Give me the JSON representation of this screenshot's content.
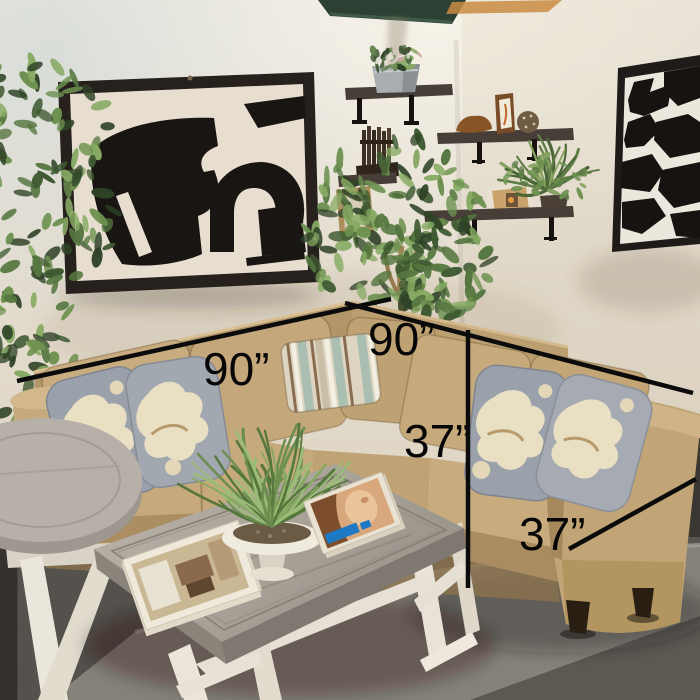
{
  "annotations": {
    "width_left": "90”",
    "width_right": "90”",
    "height": "37”",
    "depth": "37”"
  },
  "colors": {
    "dimension_line": "#0b0b0b",
    "label_text": "#060606",
    "sofa_tan": "#c3a678",
    "pillow_gray": "#9aa1ab",
    "pillow_cream": "#e9dfc2",
    "lumbar_sage": "#aabfb2",
    "lumbar_brown": "#8a6d50",
    "wall": "#e7e1d6",
    "rug": "#98928a",
    "floor_dark": "#34312e",
    "art_frame": "#26211d",
    "art_black": "#181512",
    "coffee_table_top": "#aba49b",
    "table_base_white": "#ece6da",
    "shelf_wood": "#463e37",
    "foliage_green": "#55763f",
    "pipe_green": "#2c4033",
    "magazine_accent_blue": "#1d79c4"
  },
  "scene_objects": [
    "tan-l-shaped-sectional-sofa",
    "floral-throw-pillows",
    "striped-lumbar-pillow",
    "gray-wood-coffee-table-white-trestle-base",
    "round-gray-side-table",
    "shag-area-rug",
    "abstract-black-white-art-left",
    "abstract-black-white-art-right",
    "floating-wall-shelves",
    "galvanized-planter-with-flowers",
    "carved-wood-sculpture",
    "wood-bowl",
    "woven-sphere",
    "mini-picture-frames",
    "corner-ficus-tree",
    "left-ficus-plant",
    "fern-plant",
    "grass-centerpiece-in-white-bowl",
    "interior-magazine",
    "portrait-magazine",
    "green-ceiling-pipe"
  ]
}
